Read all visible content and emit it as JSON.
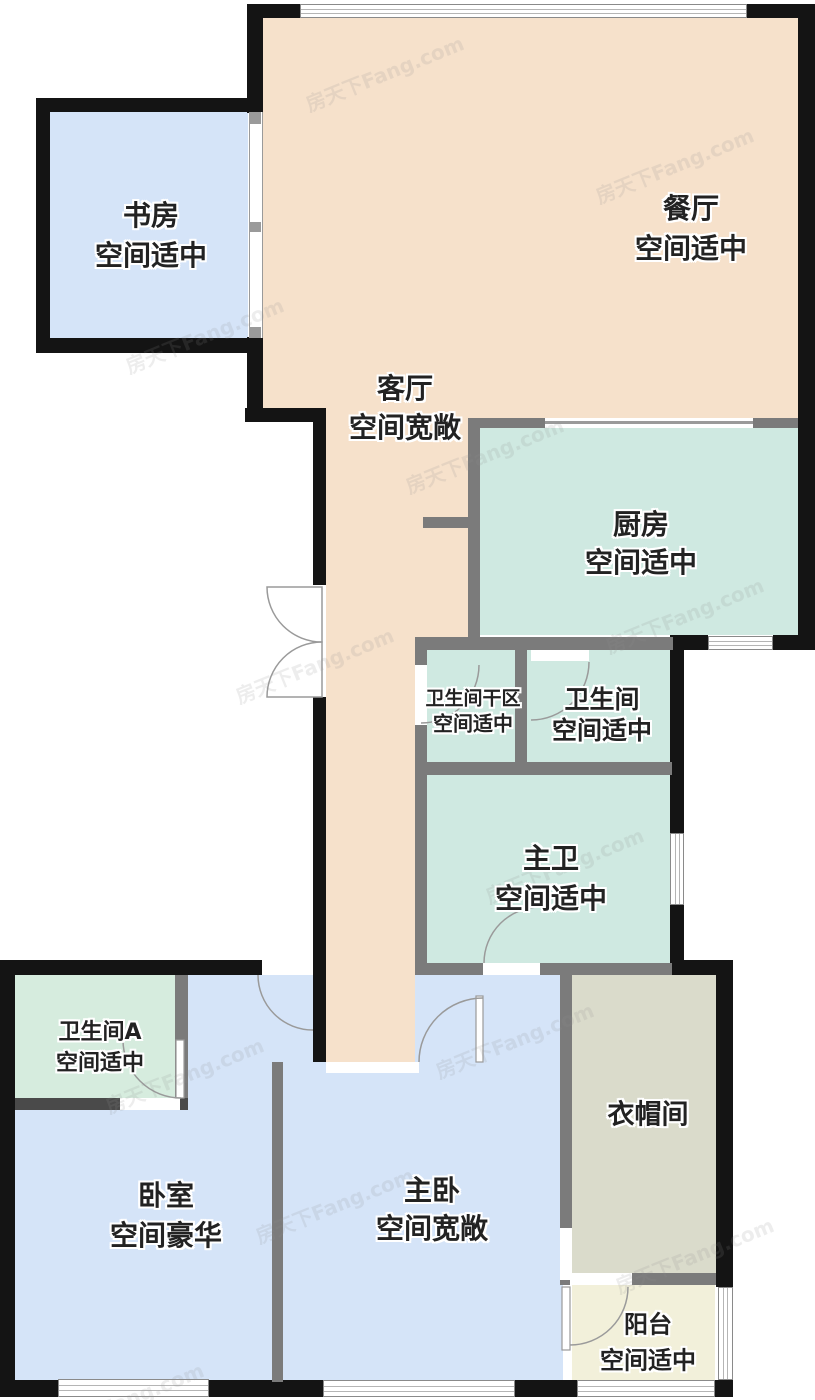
{
  "plan": {
    "watermark": "房天下Fang.com",
    "palette": {
      "wall_black": "#141414",
      "wall_gray": "#7b7b7b",
      "bedroom_blue": "#d5e4f8",
      "living_peach": "#f6e1cb",
      "kitchen_teal": "#cfe9e1",
      "bath_mint": "#d6ecde",
      "closet_olive": "#dadbcb",
      "balcony_cream": "#f2f0da"
    },
    "rooms": [
      {
        "id": "study",
        "name": "书房",
        "condition": "空间适中",
        "color": "bedroom_blue",
        "cx": 151,
        "name_y": 214,
        "cond_y": 254,
        "name_px": 28,
        "cond_px": 28
      },
      {
        "id": "dining",
        "name": "餐厅",
        "condition": "空间适中",
        "color": "living_peach",
        "cx": 691,
        "name_y": 207,
        "cond_y": 247,
        "name_px": 28,
        "cond_px": 28
      },
      {
        "id": "living",
        "name": "客厅",
        "condition": "空间宽敞",
        "color": "living_peach",
        "cx": 405,
        "name_y": 387,
        "cond_y": 426,
        "name_px": 28,
        "cond_px": 28
      },
      {
        "id": "kitchen",
        "name": "厨房",
        "condition": "空间适中",
        "color": "kitchen_teal",
        "cx": 641,
        "name_y": 523,
        "cond_y": 561,
        "name_px": 28,
        "cond_px": 28
      },
      {
        "id": "bath-dry",
        "name": "卫生间干区",
        "condition": "空间适中",
        "color": "kitchen_teal",
        "cx": 473,
        "name_y": 697,
        "cond_y": 722,
        "name_px": 19,
        "cond_px": 20
      },
      {
        "id": "bath",
        "name": "卫生间",
        "condition": "空间适中",
        "color": "kitchen_teal",
        "cx": 602,
        "name_y": 698,
        "cond_y": 729,
        "name_px": 25,
        "cond_px": 25
      },
      {
        "id": "master-bath",
        "name": "主卫",
        "condition": "空间适中",
        "color": "kitchen_teal",
        "cx": 551,
        "name_y": 857,
        "cond_y": 897,
        "name_px": 28,
        "cond_px": 28
      },
      {
        "id": "bath-a",
        "name": "卫生间A",
        "condition": "空间适中",
        "color": "bath_mint",
        "cx": 100,
        "name_y": 1030,
        "cond_y": 1061,
        "name_px": 22,
        "cond_px": 22
      },
      {
        "id": "bedroom",
        "name": "卧室",
        "condition": "空间豪华",
        "color": "bedroom_blue",
        "cx": 166,
        "name_y": 1194,
        "cond_y": 1234,
        "name_px": 28,
        "cond_px": 28
      },
      {
        "id": "master-bedroom",
        "name": "主卧",
        "condition": "空间宽敞",
        "color": "bedroom_blue",
        "cx": 432,
        "name_y": 1189,
        "cond_y": 1227,
        "name_px": 28,
        "cond_px": 28
      },
      {
        "id": "closet",
        "name": "衣帽间",
        "condition": "",
        "color": "closet_olive",
        "cx": 648,
        "name_y": 1112,
        "cond_y": null,
        "name_px": 27,
        "cond_px": 0
      },
      {
        "id": "balcony",
        "name": "阳台",
        "condition": "空间适中",
        "color": "balcony_cream",
        "cx": 648,
        "name_y": 1322,
        "cond_y": 1358,
        "name_px": 24,
        "cond_px": 24
      }
    ]
  }
}
